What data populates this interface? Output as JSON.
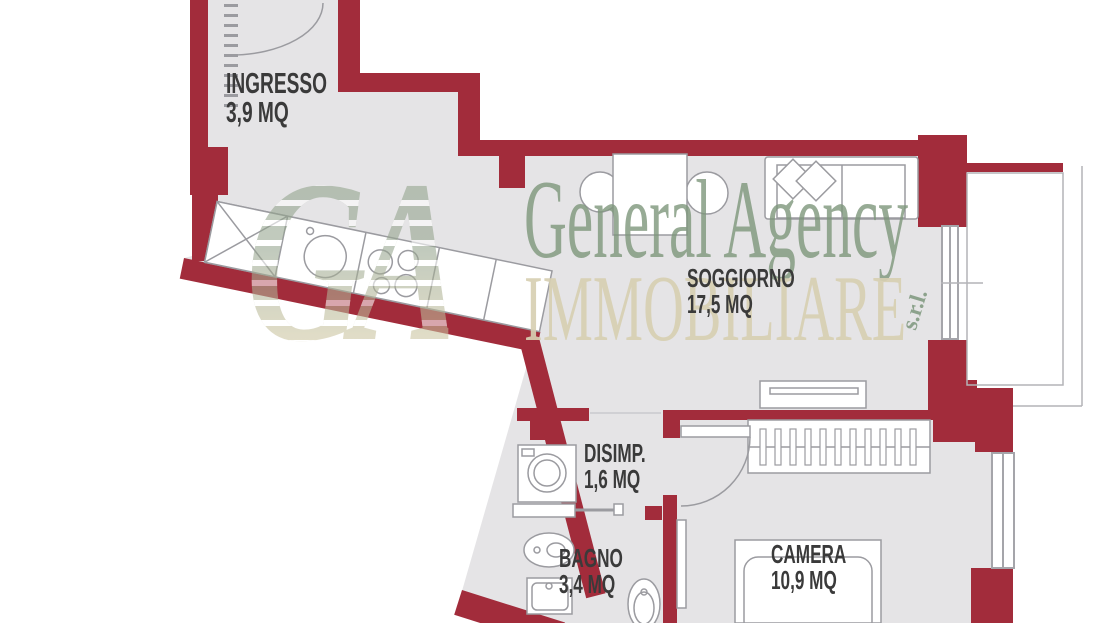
{
  "plan": {
    "type": "apartment-floor-plan",
    "colors": {
      "wall": "#a22c3b",
      "floor": "#e5e4e6",
      "furniture_line": "#9b9ba0",
      "label_text": "#3a3a3a",
      "watermark_green": "#7d967b",
      "watermark_beige": "#d7cfb2"
    }
  },
  "watermark": {
    "logo": "GA",
    "line1": "General Agency",
    "line2": "IMMOBILIARE",
    "suffix": "s.r.l."
  },
  "rooms": [
    {
      "name": "INGRESSO",
      "area": "3,9 MQ"
    },
    {
      "name": "SOGGIORNO",
      "area": "17,5 MQ"
    },
    {
      "name": "DISIMP.",
      "area": "1,6 MQ"
    },
    {
      "name": "BAGNO",
      "area": "3,4 MQ"
    },
    {
      "name": "CAMERA",
      "area": "10,9 MQ"
    }
  ]
}
